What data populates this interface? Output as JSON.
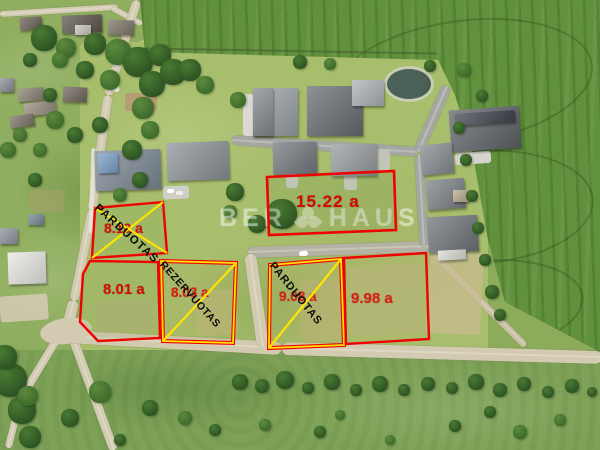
{
  "image": {
    "type": "aerial-drone-photo",
    "subject": "residential land plots for sale next to a new housing development, village and crop field"
  },
  "watermark": {
    "prefix": "BER",
    "suffix": "HAUS",
    "logo": "clover-logo"
  },
  "plots": [
    {
      "name": "plot-sold-1",
      "area": "8.10 a",
      "status": "PARDUOTAS"
    },
    {
      "name": "plot-available-1",
      "area": "8.01 a",
      "status": ""
    },
    {
      "name": "plot-reserved-1",
      "area": "8.03 a",
      "status": "REZERVUOTAS"
    },
    {
      "name": "plot-sold-2",
      "area": "9.08 a",
      "status": "PARDUOTAS"
    },
    {
      "name": "plot-available-2",
      "area": "9.98 a",
      "status": ""
    },
    {
      "name": "plot-available-3",
      "area": "15.22 a",
      "status": ""
    }
  ],
  "colors": {
    "plot_border_red": "#ee0202",
    "plot_mark_yellow": "#ffe400",
    "area_text_red": "#e10000",
    "status_text_black": "#0c0c0c"
  }
}
